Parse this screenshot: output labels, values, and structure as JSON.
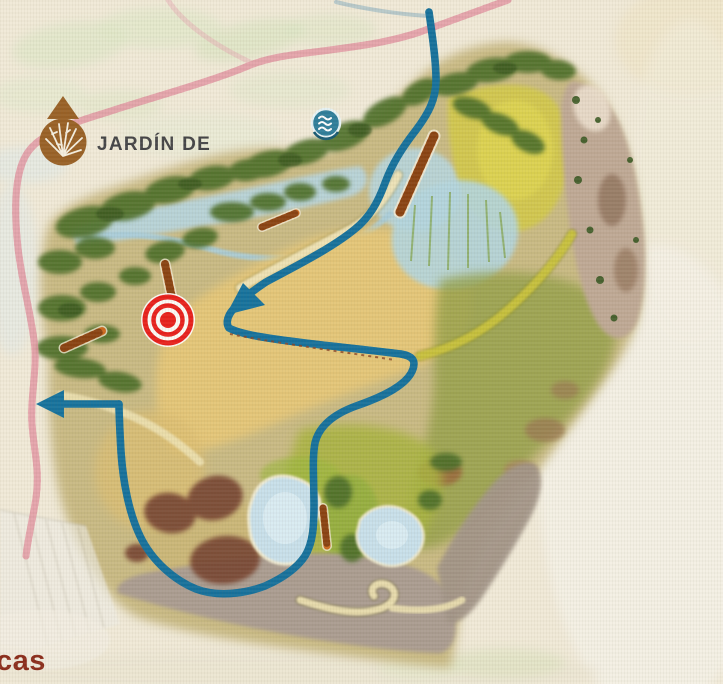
{
  "title": "Illustrated zoo-park sector map",
  "labels": {
    "garden_area": "JARDÍN DE",
    "garden_area_color": "#454547",
    "bottom_partial": "cas",
    "bottom_partial_color": "#8c2e1c"
  },
  "markers": {
    "garden": {
      "name": "garden-area-marker",
      "description": "brown circle with white agave plant and triangular pointer above",
      "color": "#996126"
    },
    "water": {
      "name": "water-feature-marker",
      "description": "teal circle with three white wave lines",
      "color": "#2f7e9a"
    },
    "location": {
      "name": "current-location-target",
      "description": "red concentric target rings",
      "color": "#e8211c",
      "x": 168,
      "y": 320
    }
  },
  "routes": {
    "visitor_trail": {
      "color": "#16729c",
      "style": "solid blue walking route",
      "arrows": [
        "large arrow pointing southwest mid-map",
        "exit arrow pointing west at left edge"
      ]
    },
    "perimeter_path": {
      "color": "#e294a0",
      "style": "faded rose path with ladder hatching along left and top edges"
    },
    "bridges": {
      "color": "#cd6a1e",
      "count": 5,
      "style": "orange ladder footbridges"
    }
  },
  "terrain": {
    "paper": "#f1ead8",
    "sand": "#e4c678",
    "meadow": "#a9b440",
    "field_yellow": "#d3c94c",
    "trees": "#4f7029",
    "water": "#b7d6e0",
    "ponds": "#c8e0ea",
    "rock_cliff": "#bfa995",
    "rock_scrub": "#ab9d92",
    "mud": "#7a4834"
  }
}
